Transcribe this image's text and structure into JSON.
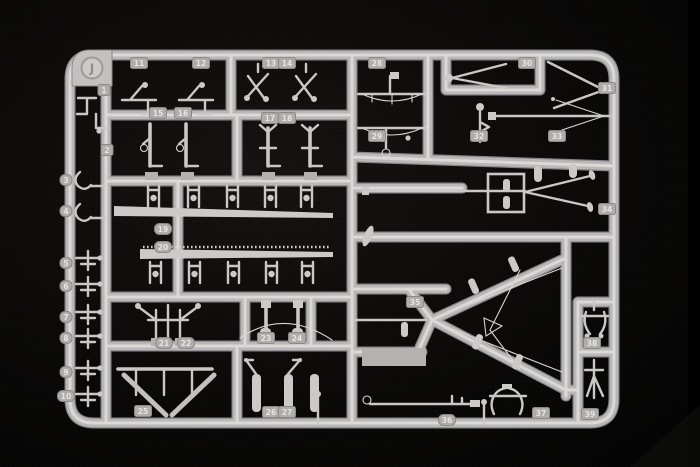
{
  "photo": {
    "subject": "plastic model kit sprue on black background",
    "sprue": {
      "letter": "J",
      "tag_count": 39,
      "tags": [
        {
          "label": "1",
          "x": 104,
          "y": 90,
          "shape": "rect"
        },
        {
          "label": "2",
          "x": 107,
          "y": 150,
          "shape": "rect"
        },
        {
          "label": "3",
          "x": 66,
          "y": 180,
          "shape": "oval"
        },
        {
          "label": "4",
          "x": 66,
          "y": 211,
          "shape": "oval"
        },
        {
          "label": "5",
          "x": 66,
          "y": 263,
          "shape": "oval"
        },
        {
          "label": "6",
          "x": 66,
          "y": 286,
          "shape": "oval"
        },
        {
          "label": "7",
          "x": 66,
          "y": 317,
          "shape": "oval"
        },
        {
          "label": "8",
          "x": 66,
          "y": 338,
          "shape": "oval"
        },
        {
          "label": "9",
          "x": 66,
          "y": 372,
          "shape": "oval"
        },
        {
          "label": "10",
          "x": 66,
          "y": 396,
          "shape": "oval"
        },
        {
          "label": "11",
          "x": 139,
          "y": 63,
          "shape": "rect"
        },
        {
          "label": "12",
          "x": 201,
          "y": 63,
          "shape": "rect"
        },
        {
          "label": "13",
          "x": 271,
          "y": 63,
          "shape": "rect"
        },
        {
          "label": "14",
          "x": 287,
          "y": 63,
          "shape": "rect"
        },
        {
          "label": "15",
          "x": 158,
          "y": 113,
          "shape": "rect"
        },
        {
          "label": "16",
          "x": 183,
          "y": 113,
          "shape": "rect"
        },
        {
          "label": "17",
          "x": 270,
          "y": 118,
          "shape": "rect"
        },
        {
          "label": "18",
          "x": 287,
          "y": 118,
          "shape": "rect"
        },
        {
          "label": "19",
          "x": 163,
          "y": 229,
          "shape": "oval"
        },
        {
          "label": "20",
          "x": 163,
          "y": 247,
          "shape": "oval"
        },
        {
          "label": "21",
          "x": 164,
          "y": 343,
          "shape": "oval"
        },
        {
          "label": "22",
          "x": 186,
          "y": 343,
          "shape": "oval"
        },
        {
          "label": "23",
          "x": 266,
          "y": 338,
          "shape": "rect"
        },
        {
          "label": "24",
          "x": 297,
          "y": 338,
          "shape": "rect"
        },
        {
          "label": "25",
          "x": 143,
          "y": 411,
          "shape": "rect"
        },
        {
          "label": "26",
          "x": 271,
          "y": 412,
          "shape": "rect"
        },
        {
          "label": "27",
          "x": 287,
          "y": 412,
          "shape": "rect"
        },
        {
          "label": "28",
          "x": 377,
          "y": 63,
          "shape": "rect"
        },
        {
          "label": "29",
          "x": 377,
          "y": 136,
          "shape": "rect"
        },
        {
          "label": "30",
          "x": 527,
          "y": 63,
          "shape": "rect"
        },
        {
          "label": "31",
          "x": 607,
          "y": 88,
          "shape": "rect"
        },
        {
          "label": "32",
          "x": 479,
          "y": 136,
          "shape": "rect"
        },
        {
          "label": "33",
          "x": 557,
          "y": 136,
          "shape": "rect"
        },
        {
          "label": "34",
          "x": 607,
          "y": 209,
          "shape": "rect"
        },
        {
          "label": "35",
          "x": 415,
          "y": 302,
          "shape": "rect"
        },
        {
          "label": "36",
          "x": 447,
          "y": 420,
          "shape": "oval"
        },
        {
          "label": "37",
          "x": 541,
          "y": 413,
          "shape": "rect"
        },
        {
          "label": "38",
          "x": 592,
          "y": 343,
          "shape": "rect"
        },
        {
          "label": "39",
          "x": 590,
          "y": 414,
          "shape": "rect"
        }
      ]
    },
    "colors": {
      "background": "#0a0908",
      "plastic_base": "#b9b8b6",
      "plastic_highlight": "#dedddb",
      "plastic_shadow": "#87868a",
      "tag_fill": "#aeadab",
      "tag_stroke": "#8b8a88",
      "tag_text": "#e6e5e3"
    }
  }
}
